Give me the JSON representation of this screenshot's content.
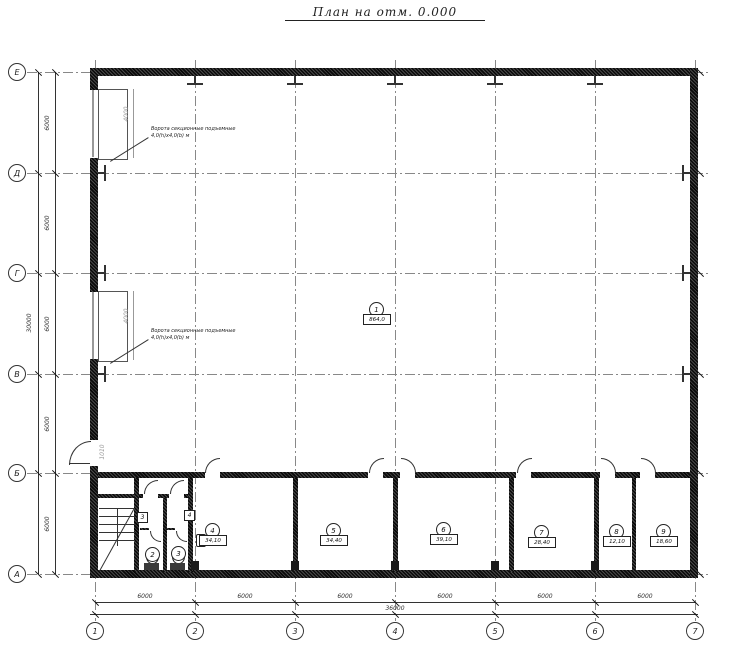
{
  "title": "План на отм. 0.000",
  "colors": {
    "wall": "#1a1a1a",
    "line": "#333333",
    "grid": "#888888",
    "dim_grey": "#999999"
  },
  "grid": {
    "cols": [
      {
        "label": "1",
        "x": 95
      },
      {
        "label": "2",
        "x": 195
      },
      {
        "label": "3",
        "x": 295
      },
      {
        "label": "4",
        "x": 395
      },
      {
        "label": "5",
        "x": 495
      },
      {
        "label": "6",
        "x": 595
      },
      {
        "label": "7",
        "x": 695
      }
    ],
    "rows": [
      {
        "label": "Е",
        "y": 72
      },
      {
        "label": "Д",
        "y": 173
      },
      {
        "label": "Г",
        "y": 273
      },
      {
        "label": "В",
        "y": 374
      },
      {
        "label": "Б",
        "y": 473
      },
      {
        "label": "А",
        "y": 574
      }
    ]
  },
  "dimensions": {
    "left_segments": [
      "6000",
      "6000",
      "6000",
      "6000",
      "6000"
    ],
    "left_total": "30000",
    "bottom_segments": [
      "6000",
      "6000",
      "6000",
      "6000",
      "6000",
      "6000"
    ],
    "bottom_total": "36000",
    "gate_width": "4000",
    "door_width": "1010"
  },
  "notes": {
    "gate1": [
      "Ворота секционные подъемные",
      "4,0(h)х4,0(b) м"
    ],
    "gate2": [
      "Ворота секционные подъемные",
      "4,0(h)х4,0(b) м"
    ]
  },
  "rooms": [
    {
      "num": "1",
      "area": "864,0",
      "cx": 376,
      "cy": 309
    },
    {
      "num": "2",
      "area": "",
      "cx": 152,
      "cy": 554
    },
    {
      "num": "3",
      "area": "",
      "cx": 178,
      "cy": 553
    },
    {
      "num": "4",
      "area": "34,10",
      "cx": 212,
      "cy": 530
    },
    {
      "num": "5",
      "area": "34,40",
      "cx": 333,
      "cy": 530
    },
    {
      "num": "6",
      "area": "39,10",
      "cx": 443,
      "cy": 529
    },
    {
      "num": "7",
      "area": "28,40",
      "cx": 541,
      "cy": 532
    },
    {
      "num": "8",
      "area": "12,10",
      "cx": 616,
      "cy": 531
    },
    {
      "num": "9",
      "area": "18,60",
      "cx": 663,
      "cy": 531
    }
  ],
  "door_tags": [
    {
      "label": "3",
      "x": 137,
      "y": 512
    },
    {
      "label": "4",
      "x": 184,
      "y": 510
    }
  ]
}
